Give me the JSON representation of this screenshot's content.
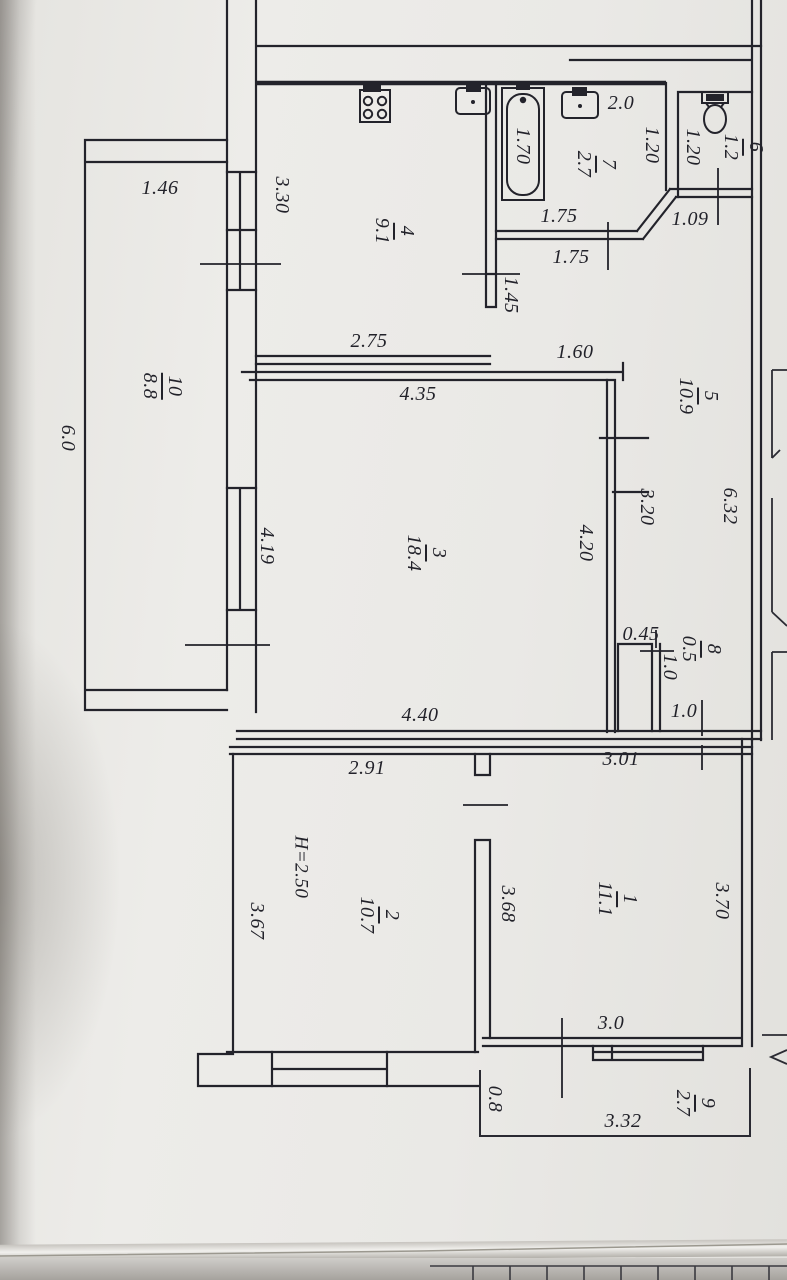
{
  "colors": {
    "ink": "#23232b",
    "paper": "#eae9e5"
  },
  "rooms": {
    "r1": {
      "num": "1",
      "area": "11.1"
    },
    "r2": {
      "num": "2",
      "area": "10.7"
    },
    "r3": {
      "num": "3",
      "area": "18.4"
    },
    "r4": {
      "num": "4",
      "area": "9.1"
    },
    "r5": {
      "num": "5",
      "area": "10.9"
    },
    "r6": {
      "num": "6",
      "area": "1.2"
    },
    "r7": {
      "num": "7",
      "area": "2.7"
    },
    "r8": {
      "num": "8",
      "area": "0.5"
    },
    "r9": {
      "num": "9",
      "area": "2.7"
    },
    "r10": {
      "num": "10",
      "area": "8.8"
    }
  },
  "dims": {
    "w146": "1.46",
    "w330": "3.30",
    "w275": "2.75",
    "w20": "2.0",
    "w175a": "1.75",
    "w175b": "1.75",
    "w109": "1.09",
    "w145": "1.45",
    "w160": "1.60",
    "w435": "4.35",
    "w632": "6.32",
    "w320": "3.20",
    "w420": "4.20",
    "w419": "4.19",
    "w60": "6.0",
    "w440": "4.40",
    "w045": "0.45",
    "w10a": "1.0",
    "w10b": "1.0",
    "w291": "2.91",
    "w301": "3.01",
    "w368": "3.68",
    "w367": "3.67",
    "w370": "3.70",
    "w170": "1.70",
    "w120a": "1.20",
    "w120b": "1.20",
    "h250": "H=2.50",
    "w30": "3.0",
    "w08": "0.8",
    "w332": "3.32"
  },
  "fixtures": [
    "stove",
    "kitchen-sink",
    "bathtub",
    "washbasin",
    "toilet"
  ]
}
